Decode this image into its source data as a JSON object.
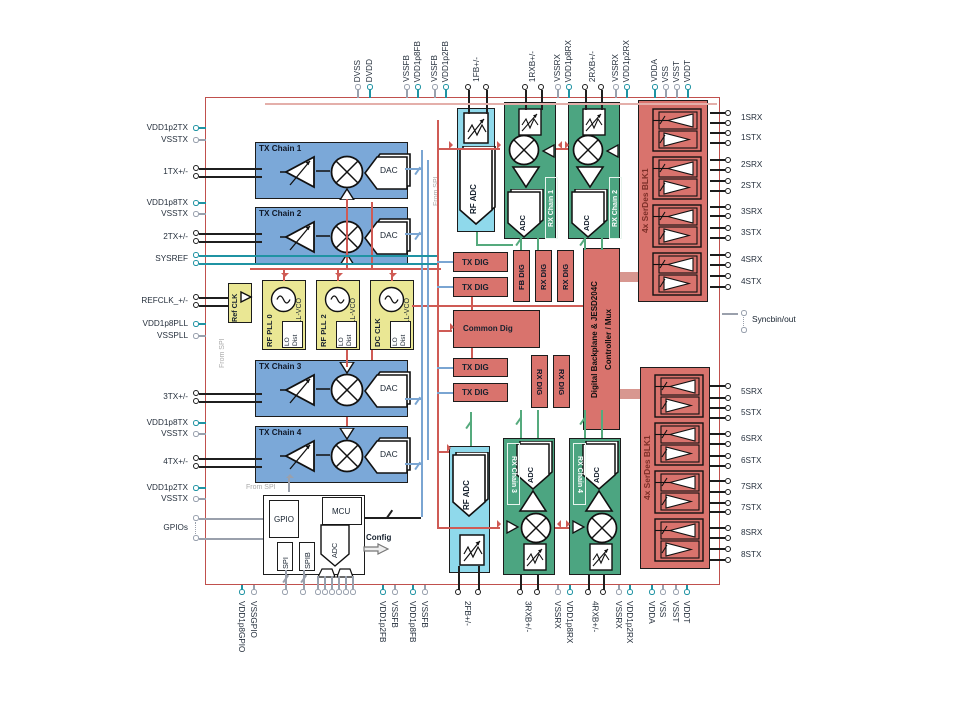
{
  "blocks": {
    "tx_chains": [
      {
        "title": "TX Chain 1",
        "dac": "DAC"
      },
      {
        "title": "TX Chain 2",
        "dac": "DAC"
      },
      {
        "title": "TX Chain 3",
        "dac": "DAC"
      },
      {
        "title": "TX Chain 4",
        "dac": "DAC"
      }
    ],
    "rx_chains": [
      {
        "label": "RX Chain 1",
        "adc": "ADC"
      },
      {
        "label": "RX Chain 2",
        "adc": "ADC"
      },
      {
        "label": "RX Chain 3",
        "adc": "ADC"
      },
      {
        "label": "RX Chain 4",
        "adc": "ADC"
      }
    ],
    "rf_adc": "RF ADC",
    "pll": {
      "ref_clk": "Ref CLK",
      "names": [
        "RF PLL 0",
        "RF PLL 2",
        "DC CLK"
      ],
      "vco": "PLL-VCO",
      "lo1": "LO",
      "lo2": "Dist"
    },
    "dig": {
      "tx": "TX DIG",
      "fb": "FB DIG",
      "rx": "RX DIG",
      "common": "Common Dig"
    },
    "jesd": {
      "line1": "Digital Backplane & JESD204C",
      "line2": "Controller / Mux"
    },
    "serdes": {
      "top": "4x SerDes BLK1",
      "bottom": "4x SerDes BLK1"
    },
    "mcu": {
      "gpio": "GPIO",
      "mcu": "MCU",
      "spi": "SPI",
      "spib": "SPIB",
      "adc": "ADC",
      "config": "Config"
    }
  },
  "annotations": {
    "from_spi": "From SPI",
    "sync": "Syncbin/out"
  },
  "pins": {
    "top": [
      "DVSS",
      "DVDD",
      "VSSFB",
      "VDD1p8FB",
      "VSSFB",
      "VDD1p2FB",
      "1FB+/-",
      "1RXB+/-",
      "VSSRX",
      "VDD1p8RX",
      "2RXB+/-",
      "VSSRX",
      "VDD1p2RX",
      "VDDA",
      "VSS",
      "VSST",
      "VDDT"
    ],
    "bottom": [
      "VDD1p8GPIO",
      "VSSGPIO",
      "VDD1p2FB",
      "VSSFB",
      "VDD1p8FB",
      "VSSFB",
      "2FB+/-",
      "3RXB+/-",
      "VSSRX",
      "VDD1p8RX",
      "4RXB+/-",
      "VSSRX",
      "VDD1p2RX",
      "VDDA",
      "VSS",
      "VSST",
      "VDDT"
    ],
    "left": [
      "VDD1p2TX",
      "VSSTX",
      "1TX+/-",
      "VDD1p8TX",
      "VSSTX",
      "2TX+/-",
      "SYSREF",
      "REFCLK_+/-",
      "VDD1p8PLL",
      "VSSPLL",
      "3TX+/-",
      "VDD1p8TX",
      "VSSTX",
      "4TX+/-",
      "VDD1p2TX",
      "VSSTX",
      "GPIOs"
    ],
    "right": [
      "1SRX",
      "1STX",
      "2SRX",
      "2STX",
      "3SRX",
      "3STX",
      "4SRX",
      "4STX",
      "Syncbin/out",
      "5SRX",
      "5STX",
      "6SRX",
      "6STX",
      "7SRX",
      "7STX",
      "8SRX",
      "8STX"
    ]
  },
  "colors": {
    "chip_border": "#C0504D",
    "tx_blue": "#7BA8D8",
    "rx_green": "#4CA581",
    "adc_cyan": "#8FD9EB",
    "dig_salmon": "#D9736D",
    "pll_yellow": "#EAE794",
    "pin_teal": "#1F93A3",
    "pin_gray": "#9AA0AC",
    "wire_red": "#CF5B55",
    "wire_blue": "#7AA5D2",
    "wire_green": "#55AA7D"
  }
}
